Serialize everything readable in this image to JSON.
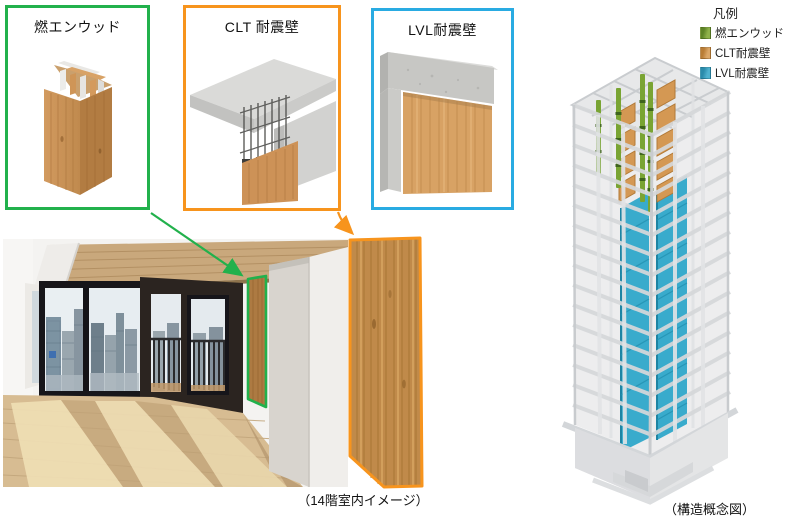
{
  "panels": {
    "moen_wood": {
      "label": "燃エンウッド"
    },
    "clt": {
      "label": "CLT 耐震壁"
    },
    "lvl": {
      "label": "LVL耐震壁"
    }
  },
  "legend": {
    "title": "凡例",
    "items": [
      {
        "label": "燃エンウッド",
        "color": "#7FA33C"
      },
      {
        "label": "CLT耐震壁",
        "color": "#D19A55"
      },
      {
        "label": "LVL耐震壁",
        "color": "#3F9FBE"
      }
    ]
  },
  "captions": {
    "room": "（14階室内イメージ）",
    "building": "（構造概念図）"
  },
  "colors": {
    "green_border": "#22B14C",
    "orange_border": "#F7941D",
    "cyan_border": "#29ABE2",
    "building_green": "#6FA02E",
    "building_orange": "#D49853",
    "building_blue": "#2FA8C9"
  }
}
